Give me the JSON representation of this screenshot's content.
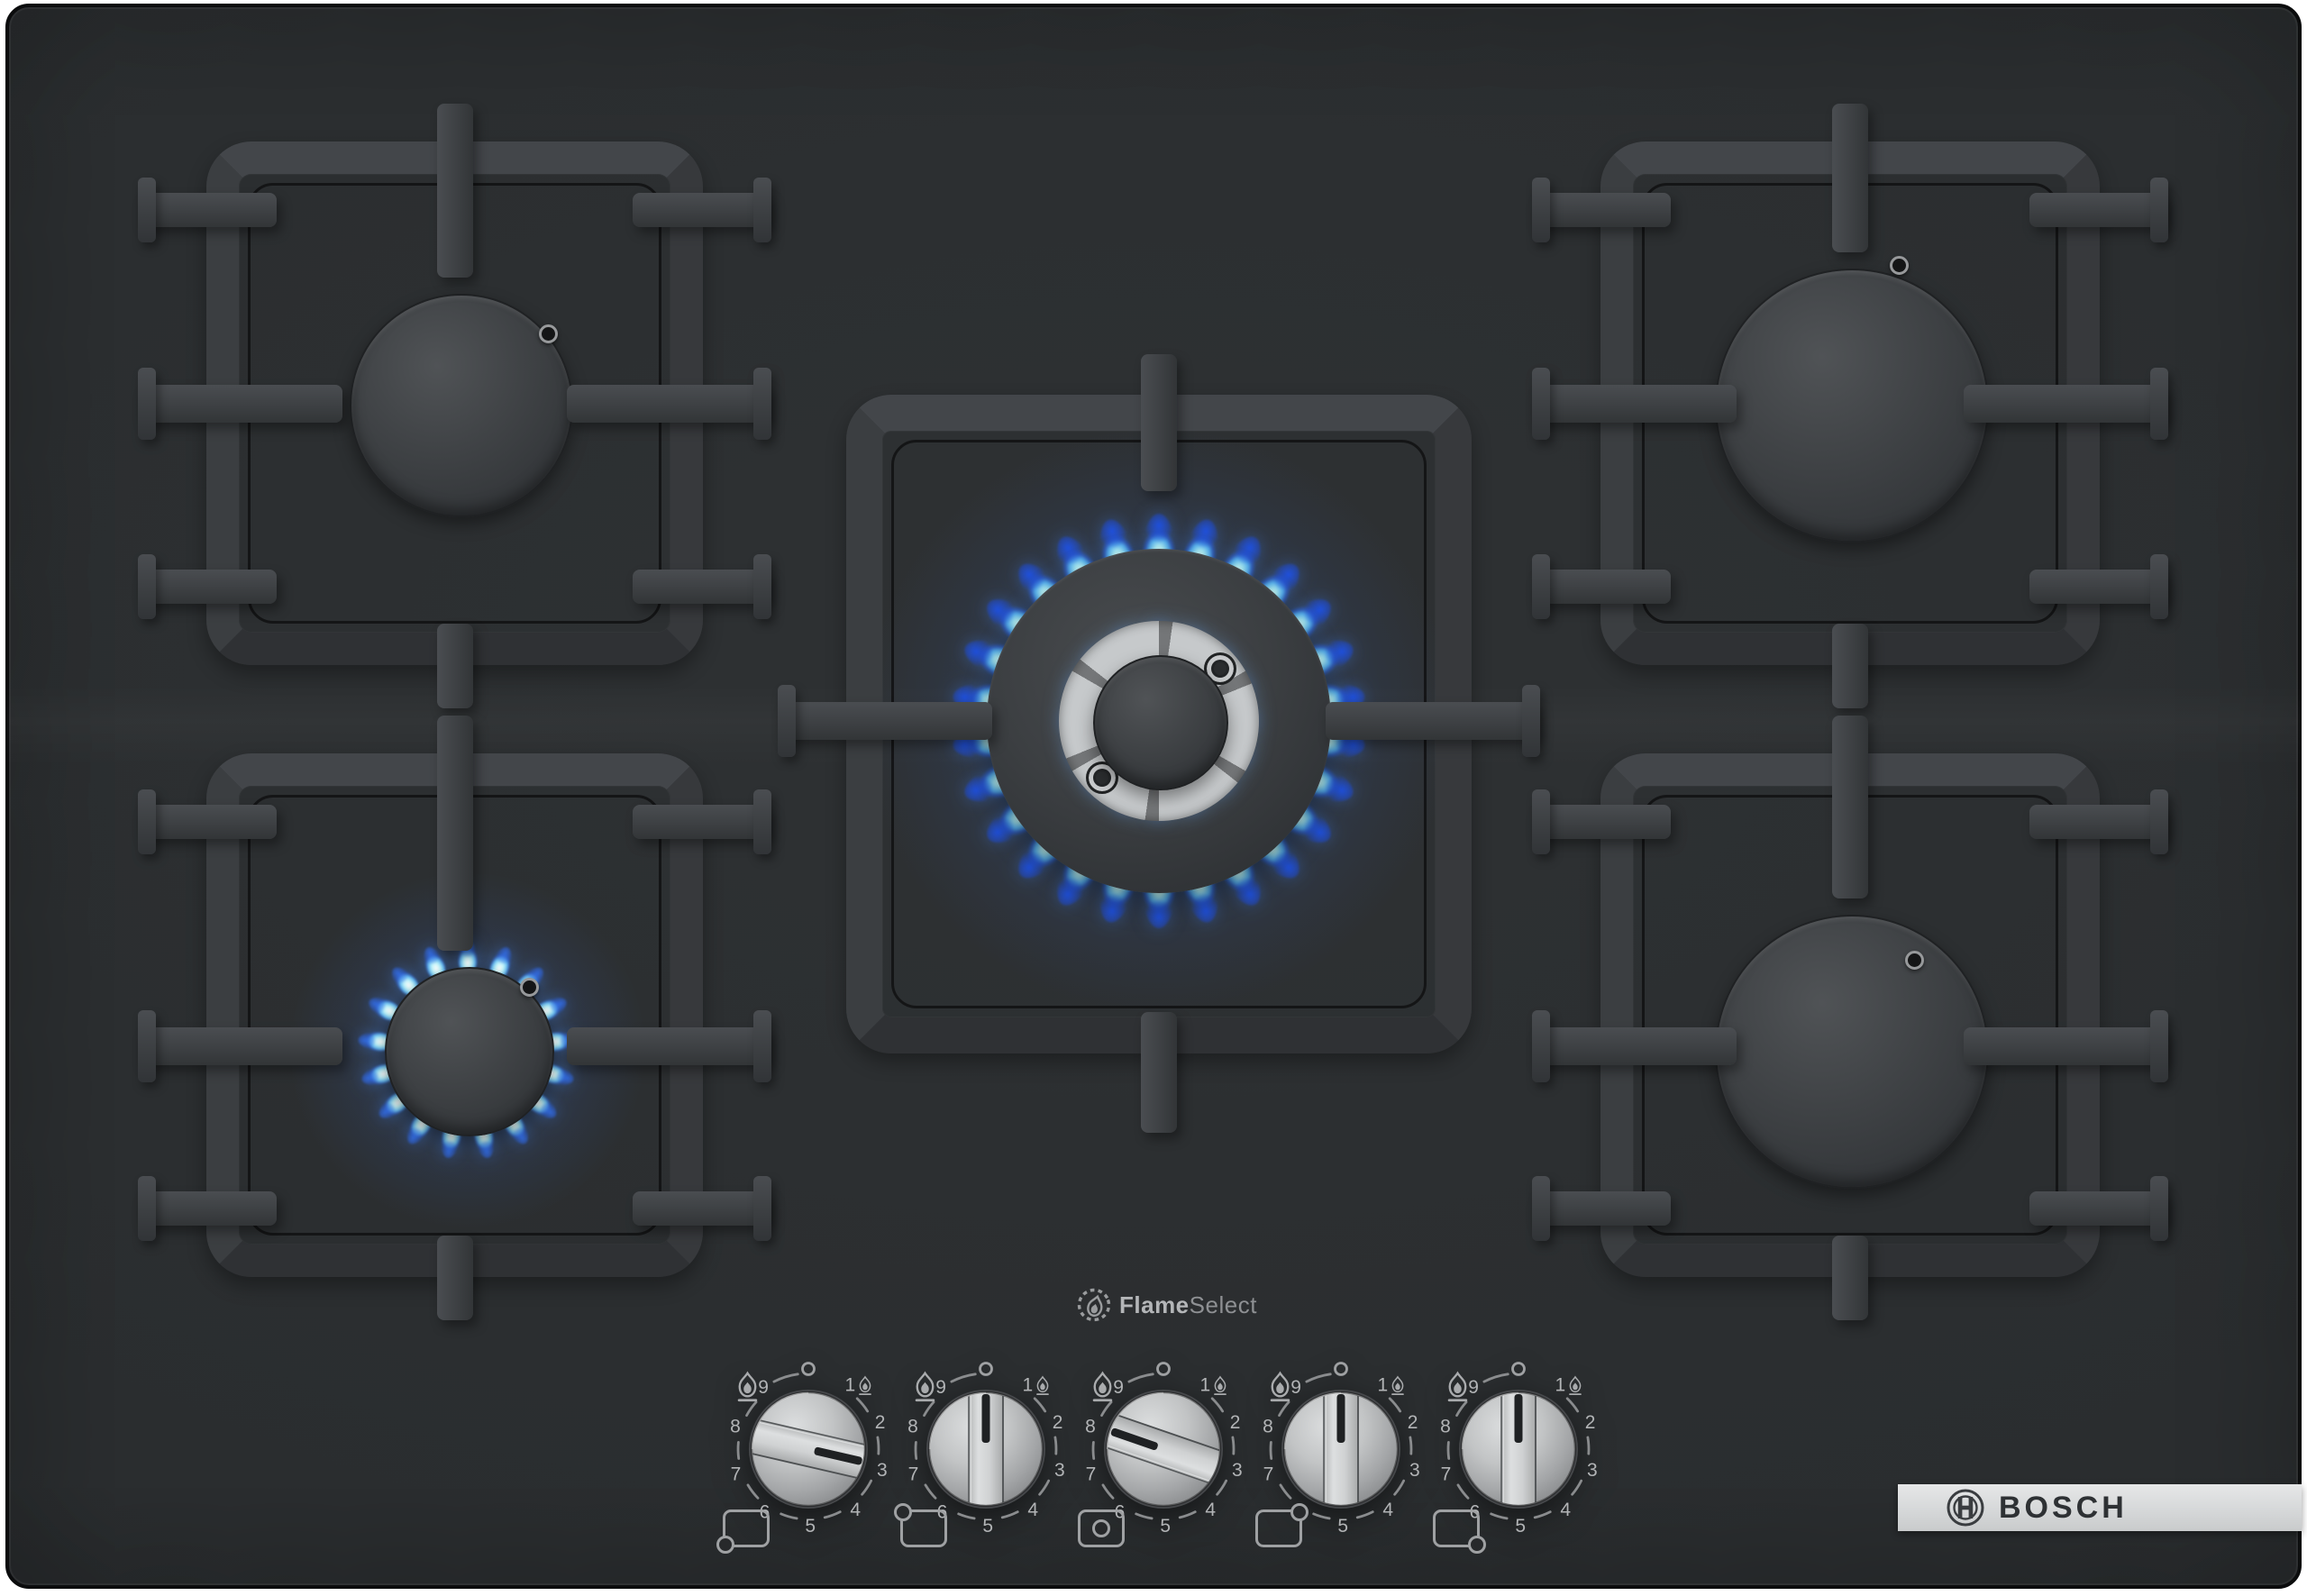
{
  "branding": {
    "bosch_label": "BOSCH",
    "bosch_logo_icon": "bosch-armature-icon",
    "flameselect": {
      "bold": "Flame",
      "regular": "Select",
      "icon": "flame-in-dashed-circle-icon"
    }
  },
  "colors": {
    "surface": "#2a2d2f",
    "bezel": "#0b0c0d",
    "grate": "#3e4144",
    "burner_cap": "#3c3f42",
    "knob_silver": "#c9cbcc",
    "knob_indicator": "#222426",
    "scale_text": "#b2b4b6",
    "flame_core": "#d9fbff",
    "flame_deep": "#2257d6",
    "logo_bar": "#d9dadb",
    "logo_text": "#2e3134"
  },
  "burners": [
    {
      "id": "back-left",
      "state": "off"
    },
    {
      "id": "front-left",
      "state": "lit-low"
    },
    {
      "id": "center",
      "state": "lit-high"
    },
    {
      "id": "back-right",
      "state": "off"
    },
    {
      "id": "front-right",
      "state": "off"
    }
  ],
  "controls": {
    "off_symbol": "0",
    "scale_numbers": [
      "1",
      "2",
      "3",
      "4",
      "5",
      "6",
      "7",
      "8",
      "9"
    ],
    "icons": {
      "high": "flame-large-icon",
      "low": "flame-small-icon"
    },
    "knobs": [
      {
        "id": "front-left",
        "burner": "front-left",
        "position_icon": "dot-bottom-left",
        "setting": "3",
        "pointer_angle": 103
      },
      {
        "id": "back-left",
        "burner": "back-left",
        "position_icon": "dot-top-left",
        "setting": "0",
        "pointer_angle": 0
      },
      {
        "id": "center",
        "burner": "center",
        "position_icon": "dot-center",
        "setting": "8",
        "pointer_angle": 289
      },
      {
        "id": "back-right",
        "burner": "back-right",
        "position_icon": "dot-top-right",
        "setting": "0",
        "pointer_angle": 0
      },
      {
        "id": "front-right",
        "burner": "front-right",
        "position_icon": "dot-bottom-right",
        "setting": "0",
        "pointer_angle": 0
      }
    ]
  }
}
